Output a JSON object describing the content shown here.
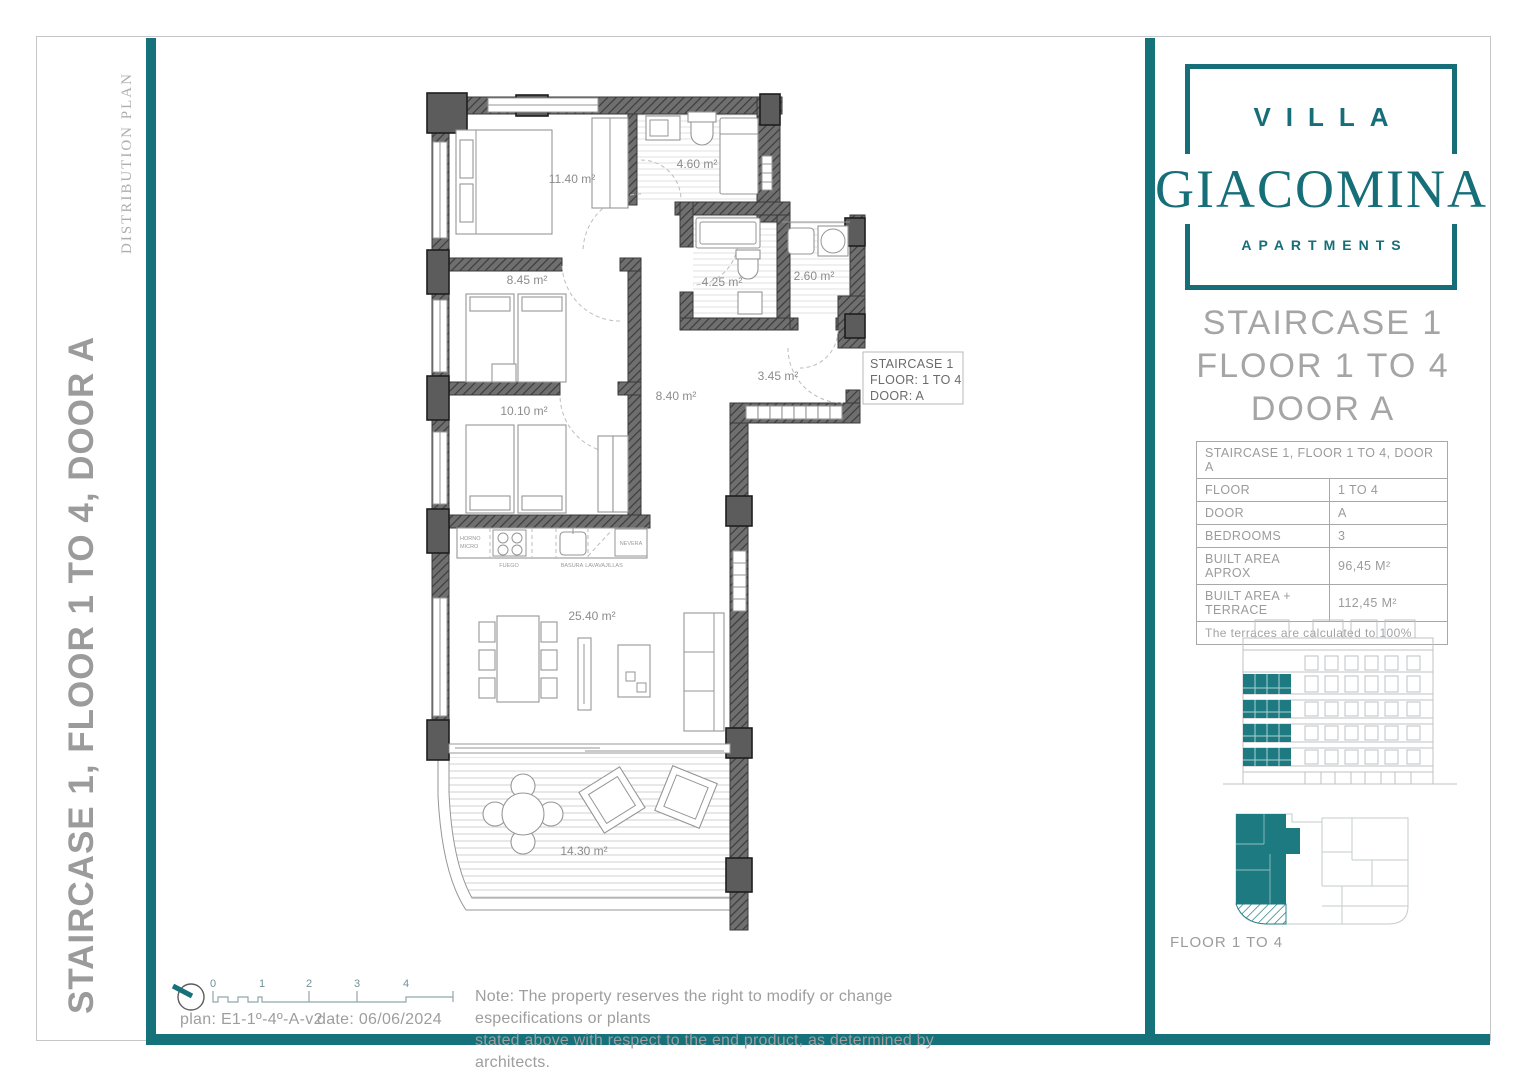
{
  "colors": {
    "teal": "#15717a",
    "teal_drawing": "#1d7a80",
    "gray_text": "#9d9d9d",
    "wall_gray": "#3e3e3e"
  },
  "sidebar": {
    "watermark": "DISTRIBUTION PLAN",
    "title": "STAIRCASE 1, FLOOR 1 TO 4, DOOR A"
  },
  "brand": {
    "line1": "VILLA",
    "line2": "GIACOMINA",
    "line3": "APARTMENTS"
  },
  "panel": {
    "title1": "STAIRCASE 1",
    "title2": "FLOOR 1 TO 4",
    "title3": "DOOR A",
    "table": {
      "header": "STAIRCASE 1, FLOOR 1 TO 4, DOOR A",
      "rows": [
        {
          "label": "FLOOR",
          "value": "1 TO 4"
        },
        {
          "label": "DOOR",
          "value": "A"
        },
        {
          "label": "BEDROOMS",
          "value": "3"
        },
        {
          "label": "BUILT AREA APROX",
          "value": "96,45 M²"
        },
        {
          "label": "BUILT AREA + TERRACE",
          "value": "112,45 M²"
        }
      ],
      "footer": "The terraces are calculated to 100%"
    },
    "floor_label": "FLOOR 1 TO 4"
  },
  "plan": {
    "areas": {
      "bedroom_main": "11.40 m²",
      "bathroom_top": "4.60 m²",
      "bedroom_2": "8.45 m²",
      "bathroom_2": "4.25 m²",
      "laundry": "2.60 m²",
      "bedroom_3": "10.10 m²",
      "hallway": "8.40 m²",
      "entrance": "3.45 m²",
      "living": "25.40 m²",
      "terrace": "14.30 m²"
    },
    "staircase_box": {
      "line1": "STAIRCASE 1",
      "line2": "FLOOR: 1 TO 4",
      "line3": "DOOR: A"
    },
    "kitchen": {
      "oven1": "HORNO",
      "oven2": "MICRO",
      "hob": "FUEGO",
      "sink": "BASURA",
      "dishwasher": "LAVAVAJILLAS",
      "fridge": "NEVERA"
    }
  },
  "footer": {
    "scale": [
      "0",
      "1",
      "2",
      "3",
      "4"
    ],
    "plan_ref": "plan: E1-1º-4º-A-v2",
    "date": "date: 06/06/2024",
    "note1": "Note: The property reserves the right to modify or change especifications or plants",
    "note2": "stated above with respect to the end product, as determined by architects."
  }
}
